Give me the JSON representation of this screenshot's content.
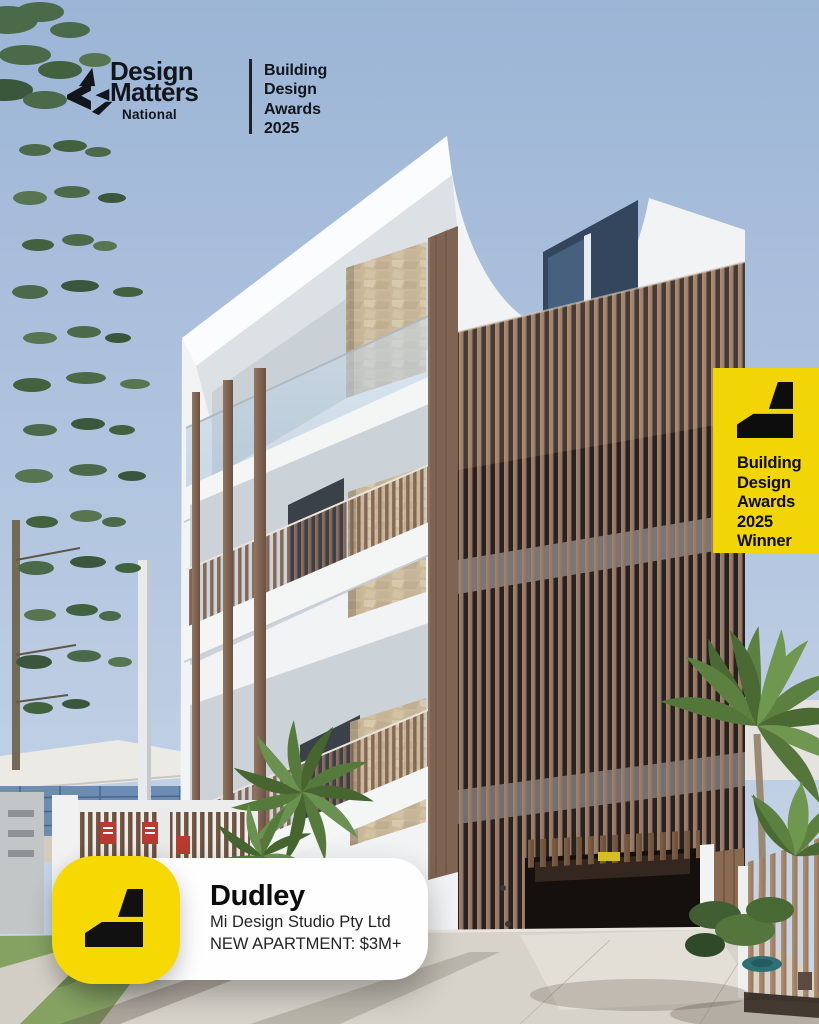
{
  "brand": {
    "line1": "Design",
    "line2": "Matters",
    "sub": "National",
    "program": [
      "Building",
      "Design",
      "Awards",
      "2025"
    ]
  },
  "winner_badge": {
    "lines": [
      "Building",
      "Design",
      "Awards",
      "2025",
      "Winner"
    ]
  },
  "project_card": {
    "title": "Dudley",
    "designer": "Mi Design Studio Pty Ltd",
    "category": "NEW APARTMENT: $3M+"
  },
  "icons": {
    "brand_mark": "design-matters-mark-icon",
    "award_mark": "award-mark-icon"
  },
  "colors": {
    "brand_yellow": "#F2D504",
    "card_yellow": "#F6D903",
    "ink": "#12161C",
    "card_bg": "#FFFFFF"
  }
}
